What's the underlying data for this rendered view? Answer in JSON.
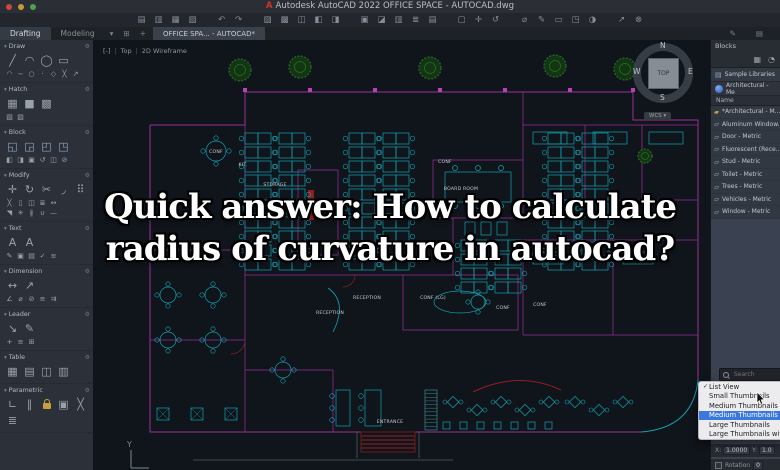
{
  "window": {
    "logo": "A",
    "title": "Autodesk AutoCAD 2022   OFFICE SPACE - AUTOCAD.dwg"
  },
  "qat_groups": [
    [
      "new-file",
      "open-file",
      "save-file",
      "save-as"
    ],
    [
      "undo",
      "redo"
    ],
    [
      "plot",
      "plot-preview",
      "publish",
      "batch-plot",
      "export"
    ],
    [
      "paste",
      "copy-clip",
      "match-properties",
      "layer",
      "group"
    ],
    [
      "select-window",
      "pan",
      "orbit"
    ],
    [
      "measure",
      "annotate",
      "named-views",
      "visual-style",
      "render"
    ],
    [
      "share",
      "sign-out"
    ]
  ],
  "workspace_tabs": [
    {
      "label": "Drafting",
      "active": true
    },
    {
      "label": "Modeling",
      "active": false
    }
  ],
  "file_tab": {
    "label": "OFFICE SPA... - AUTOCAD*"
  },
  "viewport": {
    "controls": [
      "[-]",
      "Top",
      "2D Wireframe"
    ]
  },
  "viewcube": {
    "n": "N",
    "s": "S",
    "e": "E",
    "w": "W",
    "top": "TOP",
    "wcs": "WCS ▾"
  },
  "ucs": {
    "y_label": "Y"
  },
  "palette_sections": [
    {
      "name": "Draw",
      "rows": [
        [
          "line",
          "arc",
          "circle",
          "rectangle"
        ],
        [
          "fillet",
          "spline",
          "ellipse",
          "point",
          "polygon",
          "xline",
          "ray"
        ]
      ]
    },
    {
      "name": "Hatch",
      "rows": [
        [
          "hatch-pattern",
          "hatch-solid",
          "hatch-gradient"
        ],
        [
          "hatch-boundary",
          "hatch-edit"
        ]
      ]
    },
    {
      "name": "Block",
      "rows": [
        [
          "insert-block",
          "create-block",
          "write-block",
          "block-editor"
        ],
        [
          "attribute",
          "attribute-edit",
          "block-attach",
          "block-sync",
          "block-replace",
          "purge"
        ]
      ]
    },
    {
      "name": "Modify",
      "rows": [
        [
          "move",
          "rotate",
          "trim",
          "fillet-modify",
          "array"
        ],
        [
          "erase",
          "copy",
          "mirror",
          "offset",
          "stretch"
        ],
        [
          "scale",
          "explode",
          "break",
          "join",
          "lengthen"
        ]
      ]
    },
    {
      "name": "Text",
      "rows": [
        [
          "mtext",
          "text-single"
        ],
        [
          "text-edit",
          "text-style",
          "field",
          "spell-check",
          "text-align"
        ]
      ]
    },
    {
      "name": "Dimension",
      "rows": [
        [
          "dim-linear",
          "dim-aligned"
        ],
        [
          "dim-angular",
          "dim-radius",
          "dim-diameter",
          "dim-baseline",
          "dim-continue"
        ]
      ]
    },
    {
      "name": "Leader",
      "rows": [
        [
          "mleader",
          "mleader-edit"
        ],
        [
          "mleader-add",
          "mleader-align",
          "mleader-collect"
        ]
      ]
    },
    {
      "name": "Table",
      "rows": [
        [
          "table",
          "table-cell",
          "datalink",
          "table-export"
        ]
      ]
    },
    {
      "name": "Parametric",
      "rows": [
        [
          "coincident",
          "parallel-constraint",
          "lock-constraint",
          "auto-constrain",
          "delete-constraint",
          "show-constraints"
        ]
      ]
    }
  ],
  "blocks_panel": {
    "title": "Blocks",
    "library_tab": "Sample Libraries",
    "dropdown_value": "Architectural - Me",
    "column_header": "Name",
    "items": [
      "*Architectural - M...",
      "Aluminum Window...",
      "Door - Metric",
      "Fluorescent (Rece...",
      "Stud - Metric",
      "Toilet - Metric",
      "Trees - Metric",
      "Vehicles - Metric",
      "Window - Metric"
    ],
    "search_placeholder": "Search",
    "insertion": {
      "x_label": "X:",
      "x_value": "1.0000",
      "y_label": "Y:",
      "y_value": "1.0",
      "rotation_label": "Rotation",
      "rotation_value": "0"
    }
  },
  "context_menu": {
    "items": [
      {
        "label": "List View",
        "checked": true,
        "highlighted": false
      },
      {
        "label": "Small Thumbnails",
        "checked": false,
        "highlighted": false
      },
      {
        "label": "Medium Thumbnails",
        "checked": false,
        "highlighted": false
      },
      {
        "label": "Medium Thumbnails with",
        "checked": false,
        "highlighted": true
      },
      {
        "label": "Large Thumbnails",
        "checked": false,
        "highlighted": false
      },
      {
        "label": "Large Thumbnails with",
        "checked": false,
        "highlighted": false
      }
    ]
  },
  "overlay": {
    "line1": "Quick answer: How to calculate",
    "line2": "radius of curvature in autocad?"
  },
  "floor_plan": {
    "wall_color": "#9c2f9c",
    "furniture_color": "#13a3b2",
    "tree_color": "#2a6b2a",
    "red_color": "#8f2020",
    "labels": [
      {
        "text": "KIT.",
        "x": 150,
        "y": 126
      },
      {
        "text": "STORAGE",
        "x": 182,
        "y": 146
      },
      {
        "text": "CONF",
        "x": 123,
        "y": 113
      },
      {
        "text": "CONF",
        "x": 352,
        "y": 123
      },
      {
        "text": "BOARD ROOM",
        "x": 368,
        "y": 150
      },
      {
        "text": "RECEPTION",
        "x": 274,
        "y": 259
      },
      {
        "text": "RECEPTION",
        "x": 237,
        "y": 274
      },
      {
        "text": "CONF (LG)",
        "x": 340,
        "y": 259
      },
      {
        "text": "CONF",
        "x": 410,
        "y": 269
      },
      {
        "text": "CONF",
        "x": 447,
        "y": 266
      },
      {
        "text": "ENTRANCE",
        "x": 297,
        "y": 383
      }
    ],
    "trees": [
      {
        "x": 147,
        "y": 30,
        "r": 11
      },
      {
        "x": 207,
        "y": 27,
        "r": 11
      },
      {
        "x": 337,
        "y": 28,
        "r": 11
      },
      {
        "x": 462,
        "y": 26,
        "r": 11
      },
      {
        "x": 532,
        "y": 29,
        "r": 11
      },
      {
        "x": 552,
        "y": 116,
        "r": 7
      }
    ],
    "wall_markers": [
      152,
      217,
      282,
      347,
      412,
      477,
      540
    ],
    "desk_banks": [
      {
        "x": 152,
        "y": 93,
        "rows": 10
      },
      {
        "x": 256,
        "y": 93,
        "rows": 10
      },
      {
        "x": 368,
        "y": 200,
        "rows": 4
      },
      {
        "x": 455,
        "y": 93,
        "rows": 10
      }
    ],
    "round_tables": [
      {
        "x": 123,
        "y": 111,
        "r": 10
      },
      {
        "x": 75,
        "y": 255,
        "r": 8
      },
      {
        "x": 120,
        "y": 255,
        "r": 8
      },
      {
        "x": 75,
        "y": 300,
        "r": 8
      },
      {
        "x": 120,
        "y": 300,
        "r": 8
      },
      {
        "x": 190,
        "y": 330,
        "r": 8
      },
      {
        "x": 385,
        "y": 262,
        "r": 7
      }
    ],
    "square_tables": [
      {
        "x": 64,
        "y": 368
      },
      {
        "x": 98,
        "y": 368
      },
      {
        "x": 132,
        "y": 368
      }
    ],
    "vert_tables": [
      {
        "x": 243,
        "y": 350,
        "w": 14,
        "h": 36
      },
      {
        "x": 272,
        "y": 350,
        "w": 16,
        "h": 36
      }
    ],
    "cafe_diamonds": [
      {
        "x": 360,
        "y": 362
      },
      {
        "x": 384,
        "y": 370
      },
      {
        "x": 408,
        "y": 362
      },
      {
        "x": 432,
        "y": 370
      },
      {
        "x": 456,
        "y": 362
      },
      {
        "x": 482,
        "y": 362
      },
      {
        "x": 506,
        "y": 370
      },
      {
        "x": 530,
        "y": 362
      }
    ],
    "cafe_squares": [
      350,
      367,
      384,
      401,
      418,
      435,
      452
    ],
    "entrance": {
      "x": 268,
      "y": 392,
      "w": 54,
      "h": 20,
      "steps": 5
    },
    "turnstile": {
      "x": 332,
      "y": 350,
      "w": 12,
      "h": 40
    }
  }
}
